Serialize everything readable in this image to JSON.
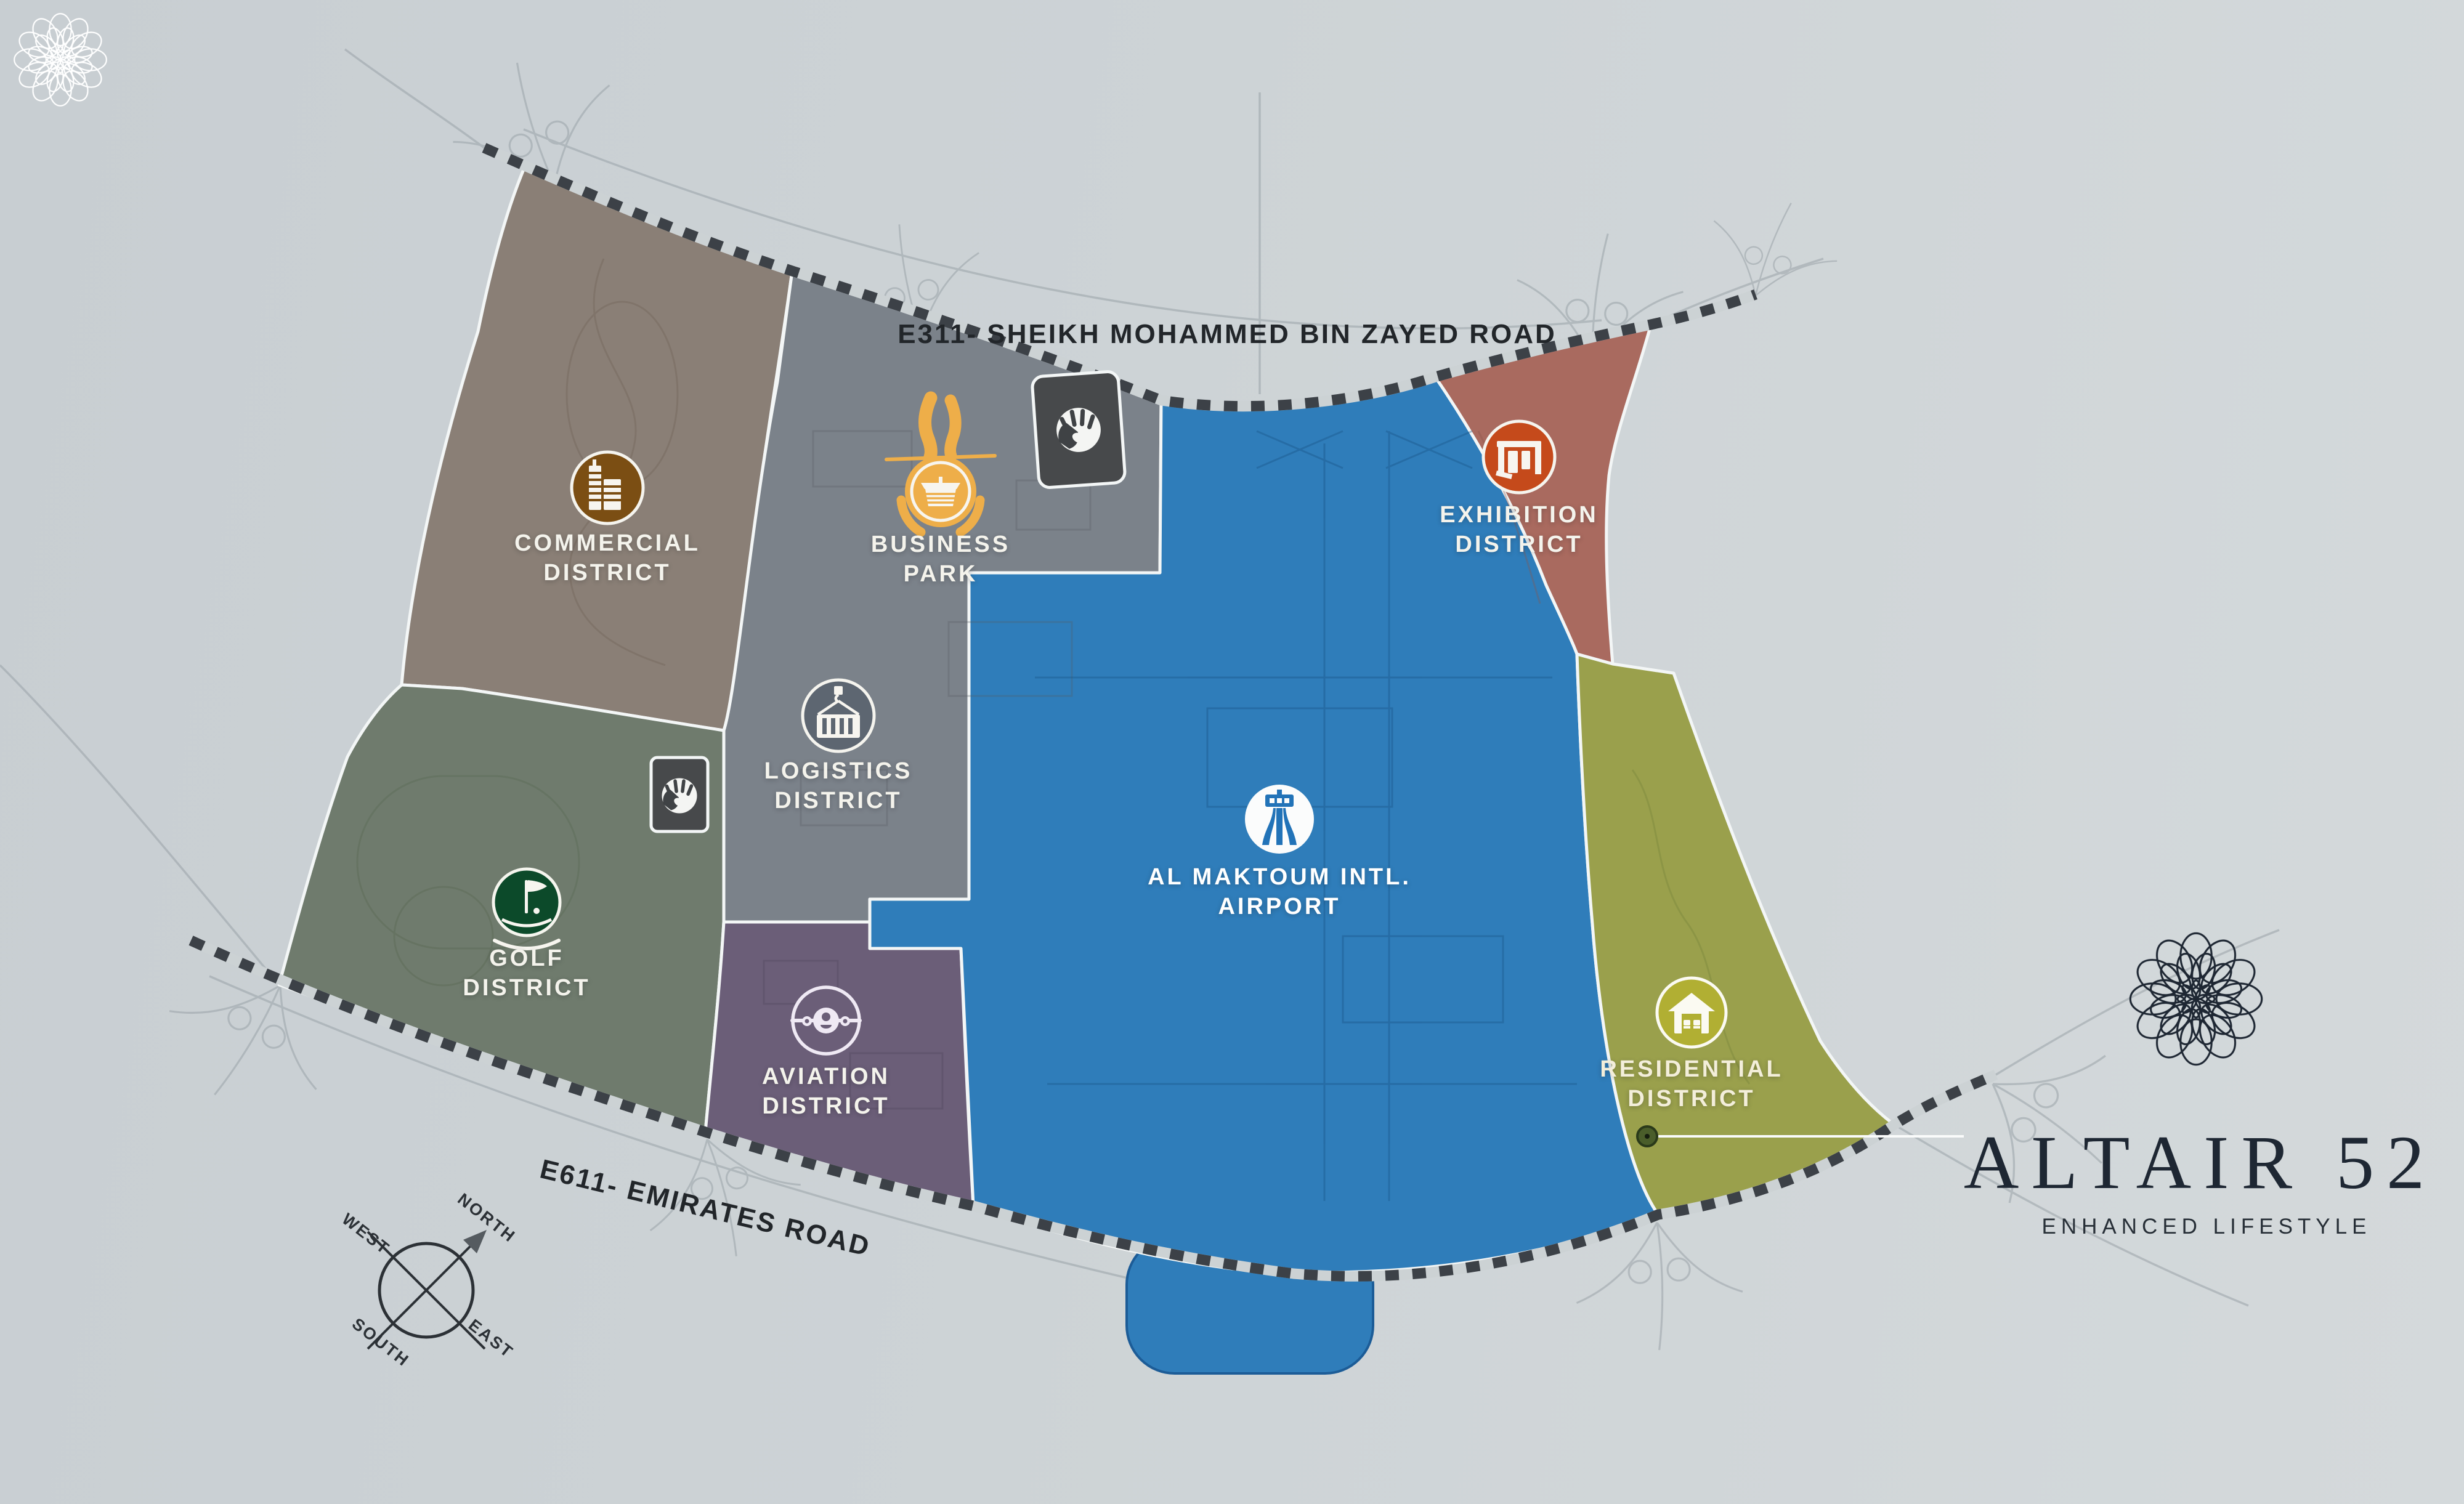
{
  "brand": {
    "name": "ALTAIR 52",
    "tagline": "ENHANCED LIFESTYLE",
    "rosette_color": "#1e2733"
  },
  "watermark": {
    "rosette_color": "#ffffff"
  },
  "roads": {
    "north": "E311- SHEIKH MOHAMMED BIN ZAYED ROAD",
    "south": "E611- EMIRATES ROAD"
  },
  "compass": {
    "north": "NORTH",
    "south": "SOUTH",
    "east": "EAST",
    "west": "WEST"
  },
  "districts": [
    {
      "id": "commercial",
      "line1": "COMMERCIAL",
      "line2": "DISTRICT",
      "icon": "buildings-icon",
      "color": "#8a7f76",
      "icon_color": "#7b4e13"
    },
    {
      "id": "business-park",
      "line1": "BUSINESS",
      "line2": "PARK",
      "icon": "pavilion-icon",
      "color": "#7b828a",
      "icon_color": "#eeae49"
    },
    {
      "id": "exhibition",
      "line1": "EXHIBITION",
      "line2": "DISTRICT",
      "icon": "exhibition-stand-icon",
      "color": "#a96a5f",
      "icon_color": "#c54a1b"
    },
    {
      "id": "logistics",
      "line1": "LOGISTICS",
      "line2": "DISTRICT",
      "icon": "crane-container-icon",
      "color": "#7b828a",
      "icon_color": "#5d6671"
    },
    {
      "id": "airport",
      "line1": "AL MAKTOUM INTL.",
      "line2": "AIRPORT",
      "icon": "control-tower-icon",
      "color": "#2f7dba",
      "icon_color": "#2273b8"
    },
    {
      "id": "golf",
      "line1": "GOLF",
      "line2": "DISTRICT",
      "icon": "golf-flag-icon",
      "color": "#6f7b6d",
      "icon_color": "#0c4a2a"
    },
    {
      "id": "aviation",
      "line1": "AVIATION",
      "line2": "DISTRICT",
      "icon": "airplane-icon",
      "color": "#6b5e78",
      "icon_color": "#6b5e78"
    },
    {
      "id": "residential",
      "line1": "RESIDENTIAL",
      "line2": "DISTRICT",
      "icon": "house-icon",
      "color": "#9aa04c",
      "icon_color": "#b1af33"
    }
  ]
}
